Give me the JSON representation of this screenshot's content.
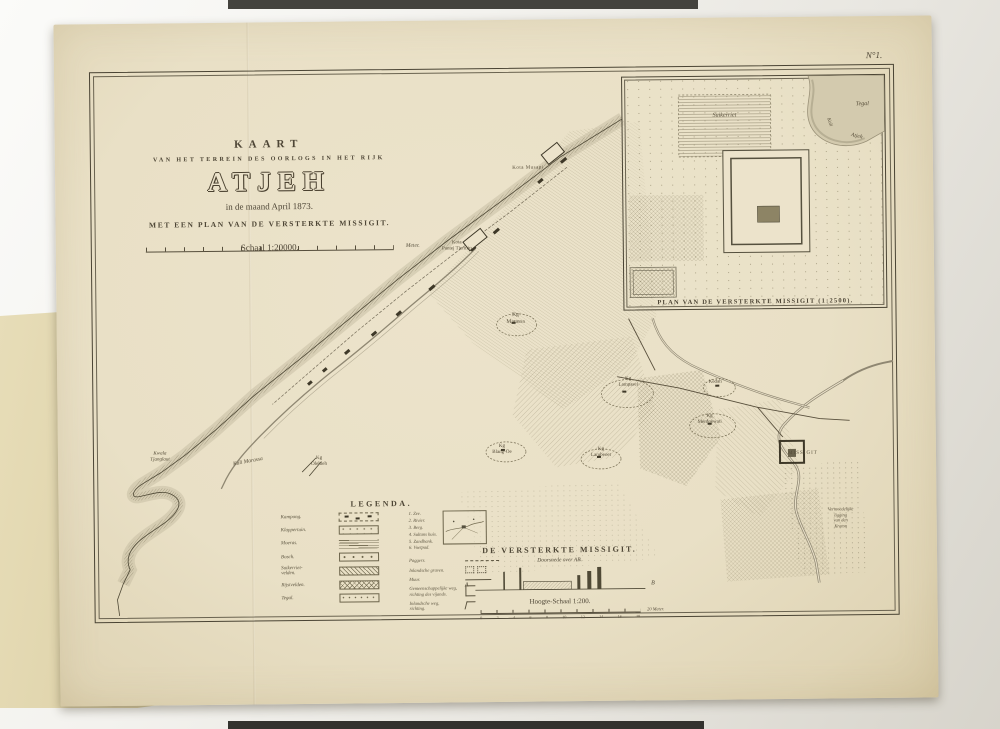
{
  "corner_label": "N°1.",
  "title_block": {
    "kicker": "KAART",
    "subkicker": "VAN HET TERREIN DES OORLOGS IN HET RIJK",
    "title": "ATJEH",
    "date_line": "in de maand April 1873.",
    "plan_line": "MET EEN PLAN VAN DE VERSTERKTE MISSIGIT.",
    "scale_label": "Schaal 1:20000.",
    "scale_unit": "Meter."
  },
  "inset": {
    "caption": "PLAN VAN DE VERSTERKTE MISSIGIT (1:2500).",
    "label_sugarcane": "Suikerriet",
    "label_tegal": "Tegal",
    "label_kali": "Kali",
    "label_atjeh": "Atjeh"
  },
  "map_labels": [
    "Kota Musapi",
    "Kota\nPantej Tjermin",
    "Kg\nMarassa",
    "Kali Marassa",
    "Kwala\nTjanglaut",
    "Kg\nOlehleh",
    "Kg\nBlang-Oe",
    "Kg\nLambeoet",
    "Kg\nLampasei",
    "Kedah",
    "Kg\nMerdoewati",
    "MISSIGIT",
    "Vermoedelijke\nligging\nvan den\nKraton"
  ],
  "legend": {
    "title": "LEGENDA.",
    "items": [
      "Kampong.",
      "Klappertuin.",
      "Moeras.",
      "Bosch.",
      "Suikerriet-\nvelden.",
      "Rijstvelden.",
      "Tegal."
    ],
    "numbered": [
      "1. Zee.",
      "2. Rivier.",
      "3. Berg.",
      "4. Sultans huis.",
      "5. Zandbank.",
      "6. Voetpad."
    ],
    "extras": [
      "Paggers.",
      "Inlandsche graven.",
      "Muur.",
      "Gemeenschappelijke weg,\nrichting des vijands.",
      "Inlandsche weg,\nrichting."
    ]
  },
  "profile": {
    "title": "DE VERSTERKTE MISSIGIT.",
    "subtitle": "Doorsnede over AB.",
    "left_mark": "A",
    "right_mark": "B",
    "scale_label": "Hoogte-Schaal 1:200.",
    "ticks": [
      "0",
      "2",
      "4",
      "6",
      "8",
      "10",
      "12",
      "14",
      "16",
      "18"
    ],
    "scale_unit": "20 Meter."
  }
}
